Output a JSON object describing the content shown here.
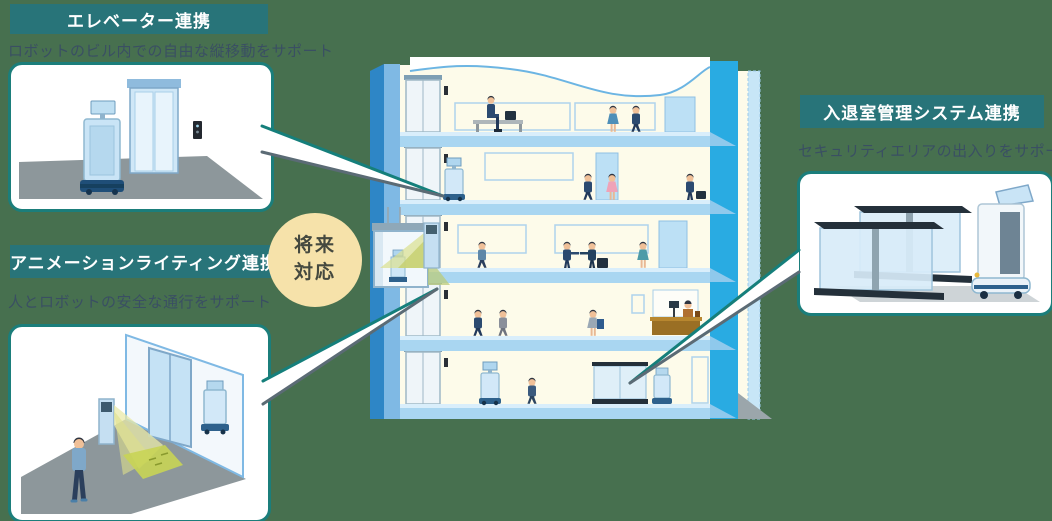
{
  "page": {
    "background_color": "#47704F",
    "accent_teal": "#1B7E7B",
    "header_bg": "#287479",
    "description_color": "#3A4F63"
  },
  "sections": {
    "elevator": {
      "title": "エレベーター連携",
      "description": "ロボットのビル内での自由な縦移動をサポート"
    },
    "lighting": {
      "title": "アニメーションライティング連携",
      "description": "人とロボットの安全な通行をサポート"
    },
    "access": {
      "title": "入退室管理システム連携",
      "description": "セキュリティエリアの出入りをサポート"
    }
  },
  "badge": {
    "bg": "#F6E2AA",
    "text_color": "#45493F",
    "line1": "将来",
    "line2": "対応"
  },
  "illustration_colors": {
    "building_wall_blue": "#3E8FCB",
    "building_column_cyan": "#29ABE2",
    "floor_slab_blue": "#A9D6F1",
    "interior_cream": "#FDFBEA",
    "robot_body": "#D2E8F8",
    "light_cone_yellow": "#DAE08F",
    "floor_gray": "#8D979B"
  }
}
